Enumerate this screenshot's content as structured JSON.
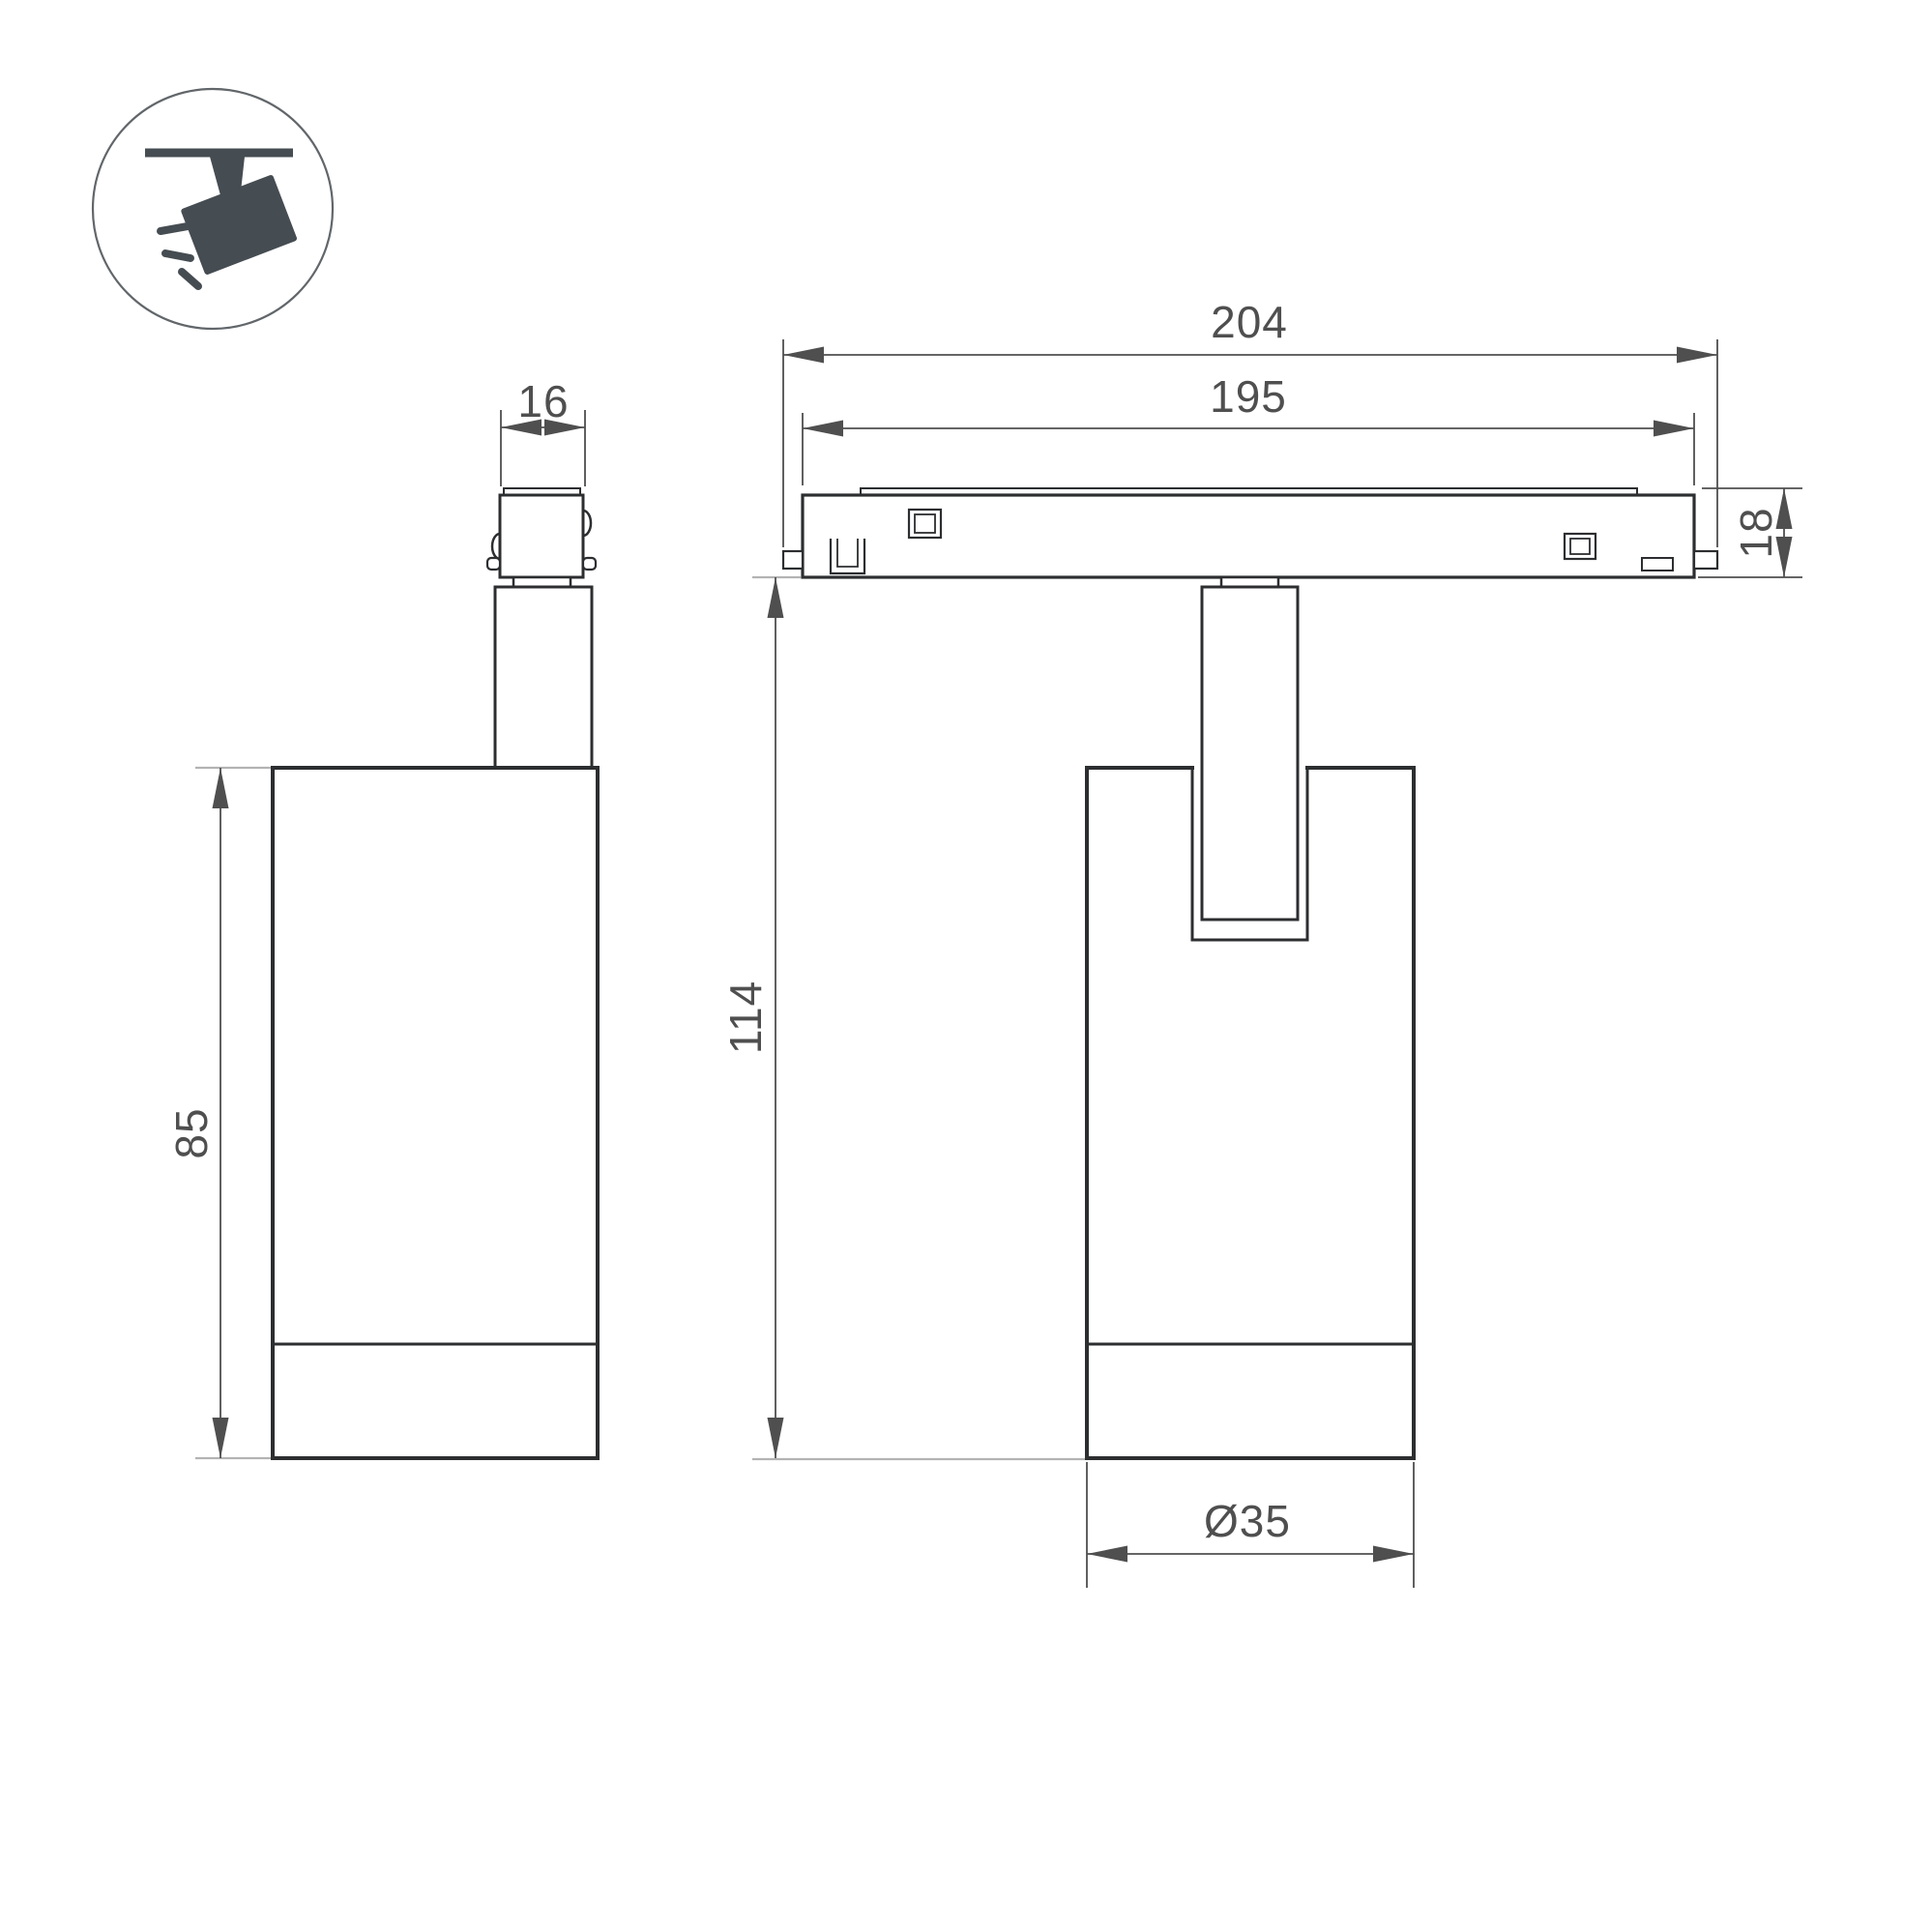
{
  "colors": {
    "line": "#2c2e30",
    "dim": "#4f4f4f",
    "ext": "#b3b3b3",
    "icon": "#454c52"
  },
  "icon": {
    "name": "ceiling-track-spotlight-pictogram"
  },
  "dimensions": {
    "adapter_width_mm": "16",
    "track_overall_length_mm": "204",
    "track_body_length_mm": "195",
    "track_height_mm": "18",
    "housing_height_mm": "85",
    "overall_height_mm": "114",
    "housing_diameter_mm": "Ø35"
  }
}
